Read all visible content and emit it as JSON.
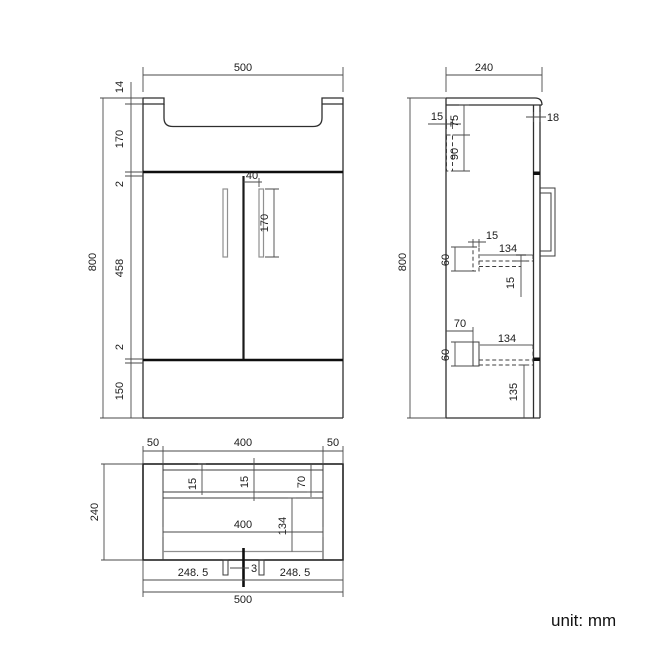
{
  "footer": {
    "unit_note": "unit: mm"
  },
  "views": {
    "front": {
      "dims": {
        "overall_width": "500",
        "overall_height": "800",
        "top_lip": "14",
        "basin_section": "170",
        "gap_top": "2",
        "door_height": "458",
        "gap_bottom": "2",
        "plinth_height": "150",
        "handle_offset": "40",
        "handle_length": "170"
      }
    },
    "side": {
      "dims": {
        "overall_depth": "240",
        "overall_height": "800",
        "wall_rail_thickness": "15",
        "worktop_to_rail": "75",
        "wall_rail_height": "90",
        "door_thickness": "18",
        "upper_bracket_width": "15",
        "upper_shelf_depth": "134",
        "upper_bracket_height": "60",
        "upper_shelf_thickness": "15",
        "lower_shelf_offset": "70",
        "lower_shelf_depth": "134",
        "lower_bracket_height": "60",
        "bottom_clearance": "135"
      }
    },
    "plan": {
      "dims": {
        "side_panel_left": "50",
        "opening_width": "400",
        "side_panel_right": "50",
        "overall_depth": "240",
        "back_panel_thickness": "15",
        "rail_thickness": "15",
        "ledge_depth": "70",
        "inner_width": "400",
        "bowl_depth": "134",
        "door_gap": "3",
        "door_left_width": "248. 5",
        "door_right_width": "248. 5",
        "overall_width": "500"
      }
    }
  }
}
